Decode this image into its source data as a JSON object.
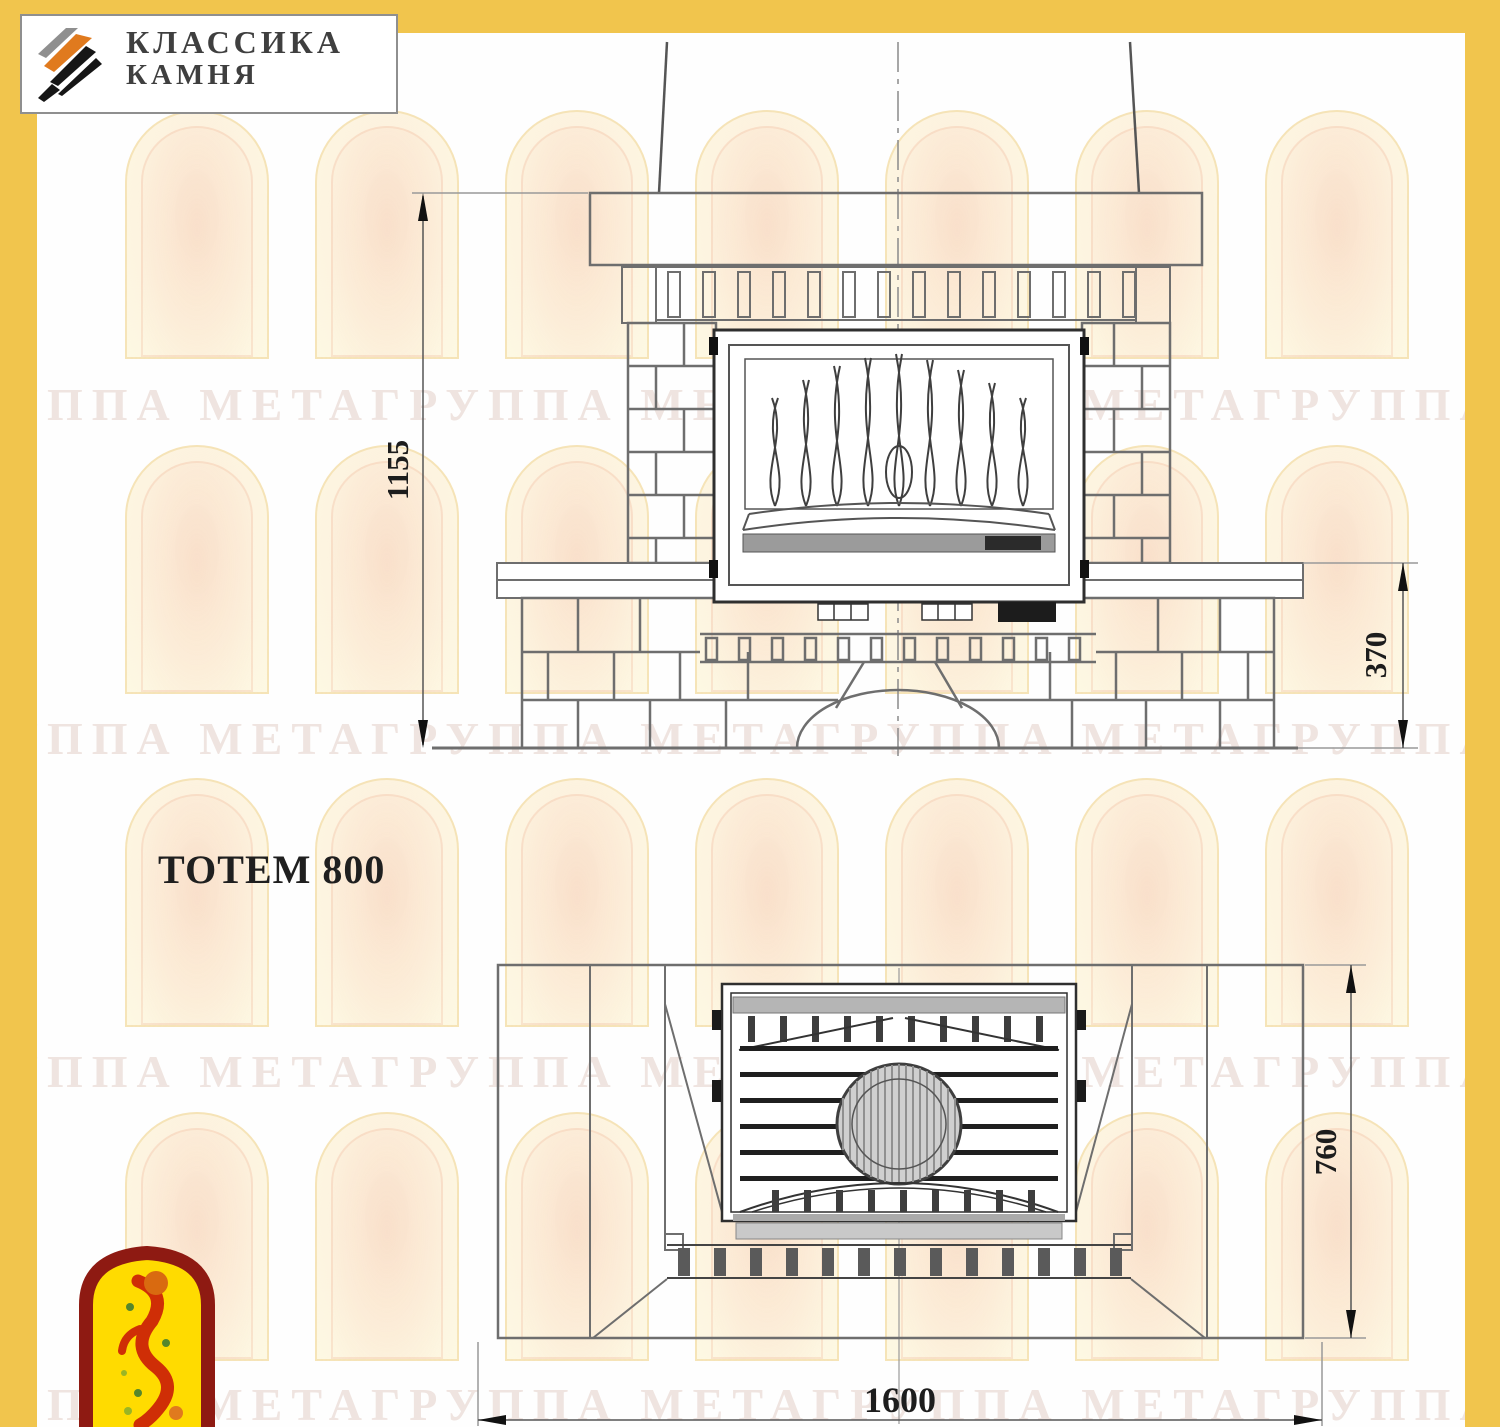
{
  "header_logo": {
    "line1": "КЛАССИКА",
    "line2": "КАМНЯ"
  },
  "model_title": "ТОТЕМ 800",
  "dimensions": {
    "front_height": "1155",
    "hearth_height": "370",
    "plan_depth": "760",
    "plan_width": "1600"
  },
  "watermark": {
    "row_text": "ГРУППА МЕТАГРУППА МЕТАГРУППА МЕТАГРУППА МЕТА"
  },
  "colors": {
    "border_yellow": "#f1c54d",
    "masonry_line": "#6e6e6e",
    "insert_line": "#2f2f2f",
    "logo_orange": "#e07a1e",
    "corner_logo_red": "#8e1a12",
    "corner_logo_yellow": "#ffdb00"
  }
}
